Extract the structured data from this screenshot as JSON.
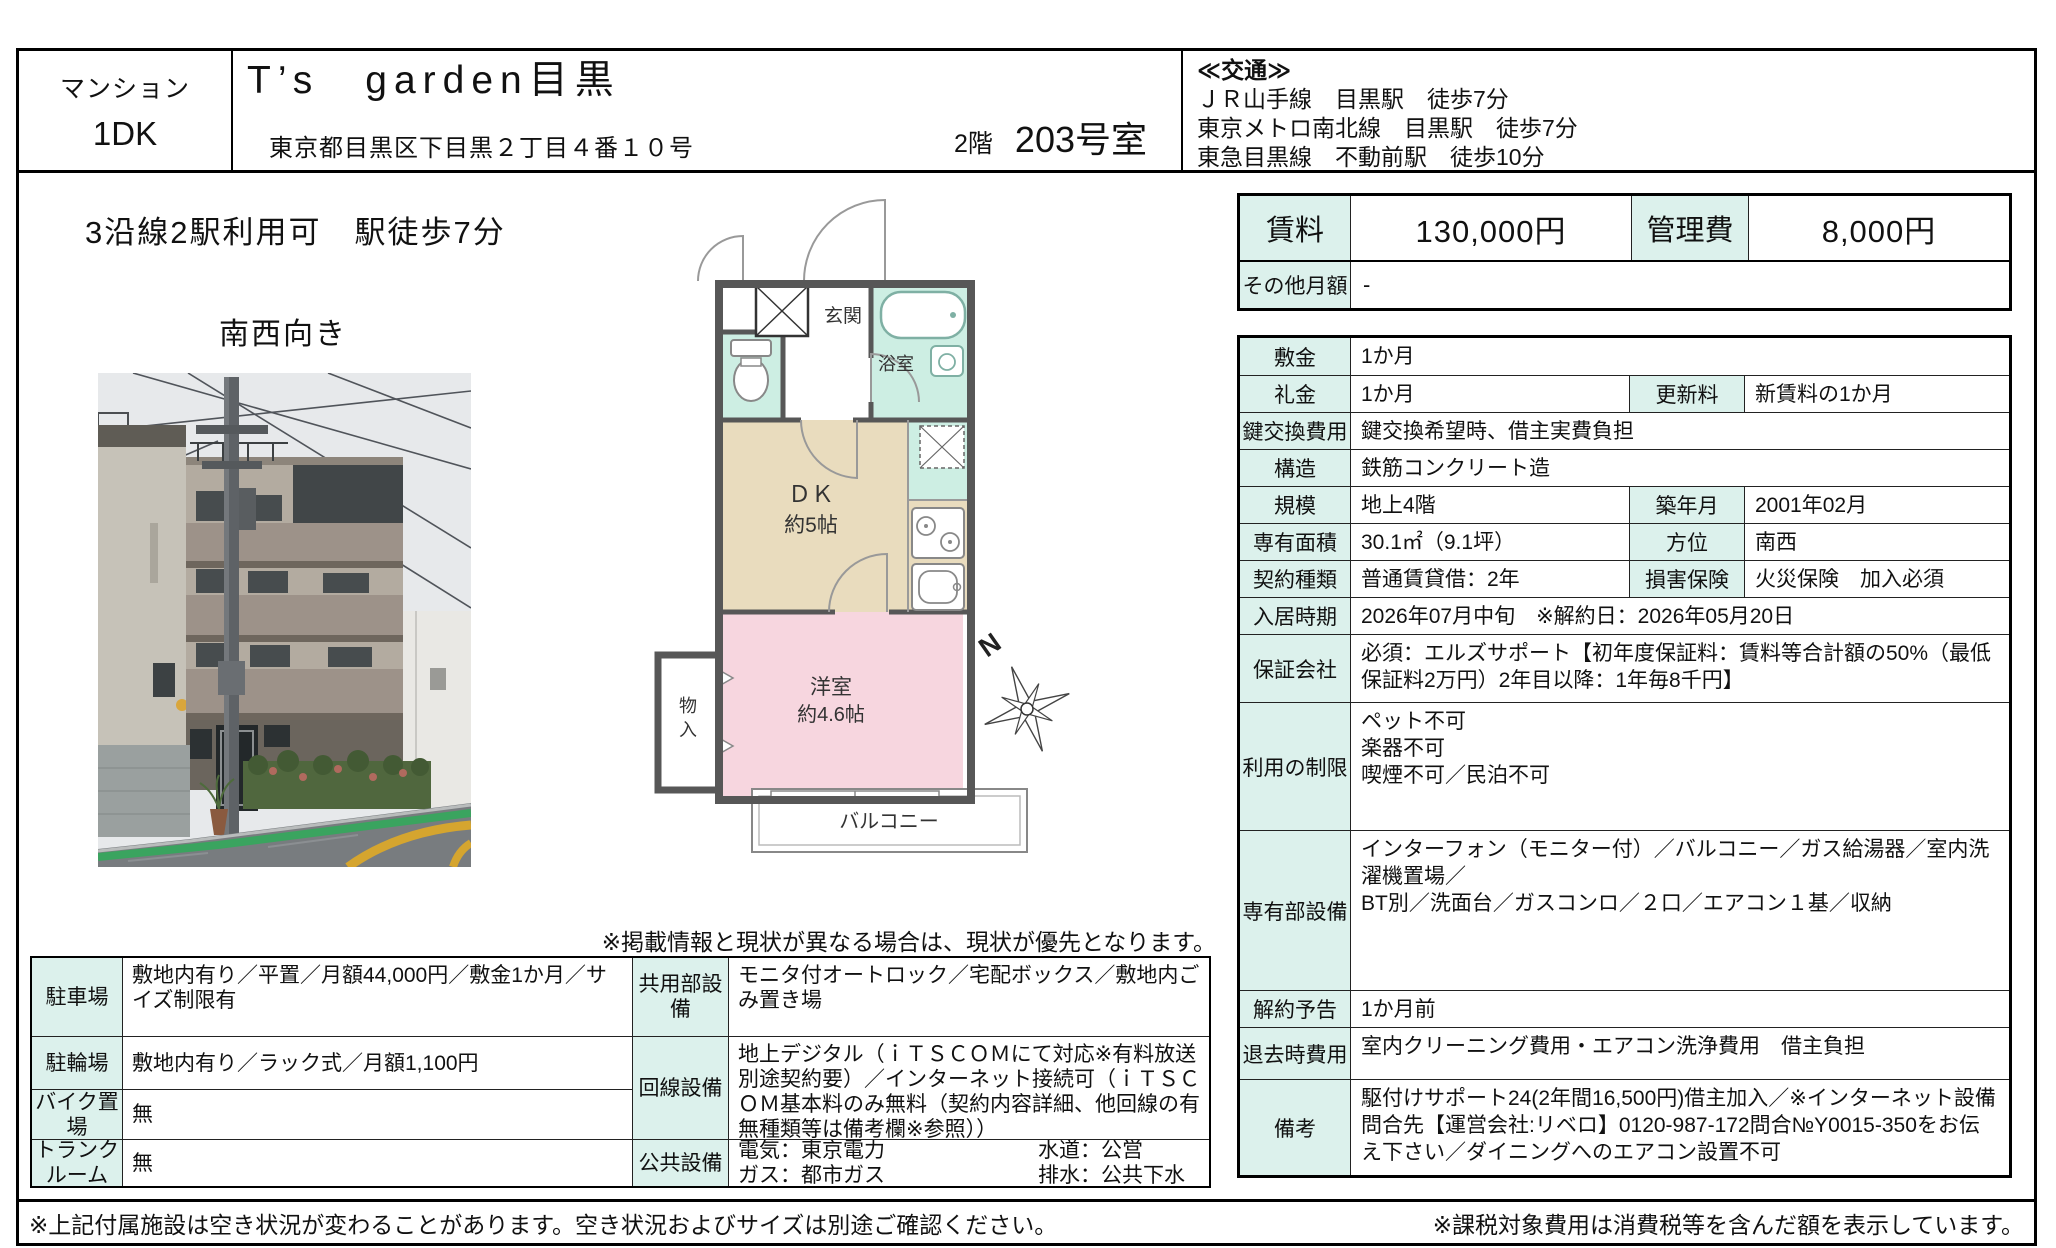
{
  "header": {
    "property_type": "マンション",
    "layout": "1DK",
    "building_name": "T’s　garden目黒",
    "address": "東京都目黒区下目黒２丁目４番１０号",
    "floor": "2階",
    "room_no": "203号室",
    "access_title": "≪交通≫",
    "access_line1": "ＪＲ山手線　目黒駅　徒歩7分",
    "access_line2": "東京メトロ南北線　目黒駅　徒歩7分",
    "access_line3": "東急目黒線　不動前駅　徒歩10分"
  },
  "catch": {
    "line1": "3沿線2駅利用可　駅徒歩7分",
    "line2": "南西向き"
  },
  "rent": {
    "rent_label": "賃料",
    "rent_value": "130,000円",
    "mgmt_label": "管理費",
    "mgmt_value": "8,000円",
    "other_label": "その他月額",
    "other_value": "-"
  },
  "details": {
    "rows": [
      {
        "label": "敷金",
        "value": "1か月"
      },
      {
        "label": "礼金",
        "value": "1か月",
        "sub_label": "更新料",
        "sub_value": "新賃料の1か月"
      },
      {
        "label": "鍵交換費用",
        "value": "鍵交換希望時、借主実費負担"
      },
      {
        "label": "構造",
        "value": "鉄筋コンクリート造"
      },
      {
        "label": "規模",
        "value": "地上4階",
        "sub_label": "築年月",
        "sub_value": "2001年02月"
      },
      {
        "label": "専有面積",
        "value": "30.1㎡（9.1坪）",
        "sub_label": "方位",
        "sub_value": "南西"
      },
      {
        "label": "契約種類",
        "value": "普通賃貸借：2年",
        "sub_label": "損害保険",
        "sub_value": "火災保険　加入必須"
      },
      {
        "label": "入居時期",
        "value": "2026年07月中旬　※解約日：2026年05月20日"
      },
      {
        "label": "保証会社",
        "value": "必須：エルズサポート【初年度保証料：賃料等合計額の50%（最低保証料2万円）2年目以降：1年毎8千円】"
      },
      {
        "label": "利用の制限",
        "value": "ペット不可\n楽器不可\n喫煙不可／民泊不可"
      },
      {
        "label": "専有部設備",
        "value": "インターフォン（モニター付）／バルコニー／ガス給湯器／室内洗濯機置場／\nBT別／洗面台／ガスコンロ／２口／エアコン１基／収納"
      },
      {
        "label": "解約予告",
        "value": "1か月前"
      },
      {
        "label": "退去時費用",
        "value": "室内クリーニング費用・エアコン洗浄費用　借主負担"
      },
      {
        "label": "備考",
        "value": "駆付けサポート24(2年間16,500円)借主加入／※インターネット設備問合先【運営会社:リベロ】0120-987-172問合№Y0015-350をお伝え下さい／ダイニングへのエアコン設置不可"
      }
    ]
  },
  "facilities": {
    "parking_label": "駐車場",
    "parking_value": "敷地内有り／平置／月額44,000円／敷金1か月／サイズ制限有",
    "bicycle_label": "駐輪場",
    "bicycle_value": "敷地内有り／ラック式／月額1,100円",
    "bike_label": "バイク置場",
    "bike_value": "無",
    "trunk_label": "トランクルーム",
    "trunk_value": "無",
    "common_label": "共用部設備",
    "common_value": "モニタ付オートロック／宅配ボックス／敷地内ごみ置き場",
    "network_label": "回線設備",
    "network_value": "地上デジタル（ｉＴＳＣＯＭにて対応※有料放送別途契約要）／インターネット接続可（ｉＴＳＣＯＭ基本料のみ無料（契約内容詳細、他回線の有無種類等は備考欄※参照））",
    "public_label": "公共設備",
    "public_left": "電気：東京電力\nガス：都市ガス",
    "public_right": "水道：公営\n排水：公共下水"
  },
  "floorplan": {
    "entrance": "玄関",
    "bathroom": "浴室",
    "dk_line1": "ＤＫ",
    "dk_line2": "約5帖",
    "bedroom_line1": "洋室",
    "bedroom_line2": "約4.6帖",
    "storage_char1": "物",
    "storage_char2": "入",
    "balcony": "バルコニー",
    "compass_n": "N"
  },
  "notes": {
    "mid": "※掲載情報と現状が異なる場合は、現状が優先となります。",
    "footer_left": "※上記付属施設は空き状況が変わることがあります。空き状況およびサイズは別途ご確認ください。",
    "footer_right": "※課税対象費用は消費税等を含んだ額を表示しています。"
  }
}
